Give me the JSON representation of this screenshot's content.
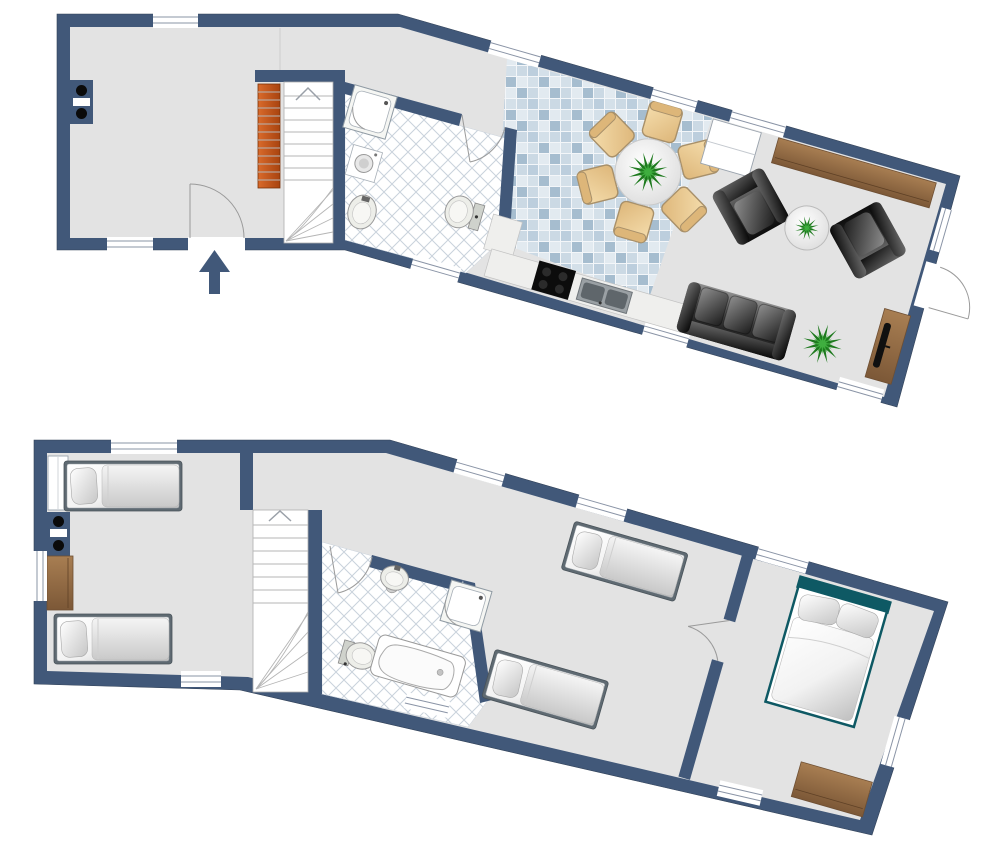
{
  "document": {
    "type": "architectural-floor-plan",
    "visible_text": [],
    "floors": [
      {
        "id": "ground-floor",
        "rooms": [
          {
            "name": "entry-hall",
            "furniture": [
              "wall-stove",
              "radiator",
              "staircase",
              "entrance-door",
              "entrance-arrow"
            ]
          },
          {
            "name": "bathroom",
            "furniture": [
              "shower",
              "washing-machine",
              "washbasin",
              "toilet"
            ]
          },
          {
            "name": "dining-kitchen",
            "furniture": [
              "round-dining-table",
              "six-chairs",
              "centerpiece-plant",
              "kitchen-counter",
              "cooktop",
              "double-sink",
              "kitchen-cabinet"
            ]
          },
          {
            "name": "living-room",
            "furniture": [
              "sideboard",
              "armchair",
              "armchair",
              "coffee-table",
              "sofa",
              "floor-plant",
              "tv-board",
              "terrace-door"
            ]
          }
        ]
      },
      {
        "id": "upper-floor",
        "rooms": [
          {
            "name": "bedroom-left",
            "furniture": [
              "single-bed",
              "single-bed",
              "closet",
              "wall-stove",
              "dresser"
            ]
          },
          {
            "name": "landing",
            "furniture": [
              "staircase",
              "single-bed"
            ]
          },
          {
            "name": "bathroom",
            "furniture": [
              "pedestal-washbasin",
              "shower",
              "toilet",
              "bathtub"
            ]
          },
          {
            "name": "bedroom-middle",
            "furniture": [
              "single-bed"
            ]
          },
          {
            "name": "bedroom-master",
            "furniture": [
              "double-bed",
              "dresser"
            ]
          }
        ]
      }
    ]
  },
  "colors": {
    "wall": "#415879",
    "floor": "#E3E3E3",
    "bath_floor": "#FFFFFF",
    "lattice": "#C9D2DC",
    "tile_grout": "#F3F6F9",
    "tile1": "#BCCEDD",
    "tile2": "#D4E0E9",
    "tile3": "#A6BDCF",
    "tile4": "#CBD9E4",
    "tile5": "#E2EAF0",
    "wood_light": "#A87E52",
    "wood_dark": "#7C5837",
    "radiator_light": "#D96A2B",
    "radiator_dark": "#A8430F",
    "leather_light": "#8E8E8E",
    "leather_dark": "#0D0D0D",
    "chair_light": "#F6DFAF",
    "chair_dark": "#DDB679",
    "chair_border": "#A8906A",
    "plant_dark": "#1E7A1E",
    "plant_light": "#3FAE3F",
    "plant_teal": "#2E8B8B",
    "bed_frame": "#5F6A72",
    "bed_teal": "#0E5964",
    "window_line": "#8A94A6",
    "door_arc": "#9A9A9A",
    "stair_line": "#B5B5B5",
    "entrance_arrow": "#415879"
  }
}
